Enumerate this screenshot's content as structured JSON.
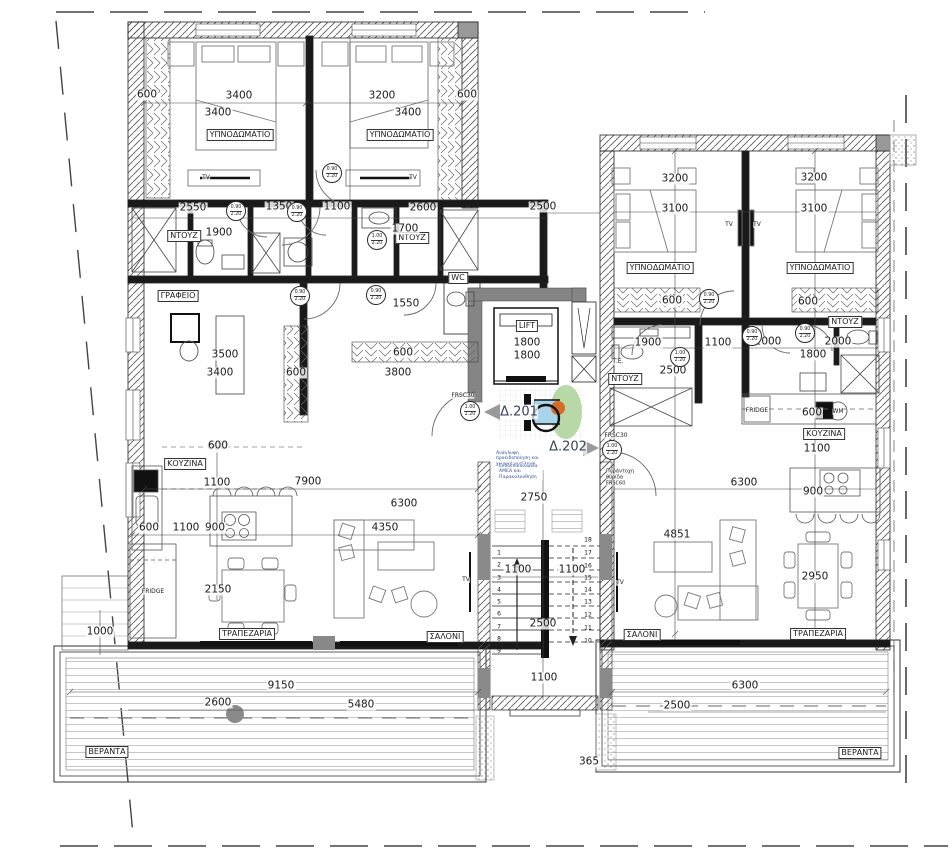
{
  "palette": {
    "wall_hatch": "#555",
    "wall_dark": "#1a1a1a",
    "wall_gray": "#858585",
    "boundary": "#444",
    "deck_line": "#b9b9b9",
    "accent_green": "#b8d8a8",
    "accent_blue": "#a7d4e8",
    "accent_orange": "#d96b28"
  },
  "labels": {
    "room": [
      {
        "t": "ΥΠΝΟΔΩΜΑΤΙΟ",
        "x": 240,
        "y": 135
      },
      {
        "t": "ΥΠΝΟΔΩΜΑΤΙΟ",
        "x": 400,
        "y": 135
      },
      {
        "t": "ΥΠΝΟΔΩΜΑΤΙΟ",
        "x": 660,
        "y": 268
      },
      {
        "t": "ΥΠΝΟΔΩΜΑΤΙΟ",
        "x": 820,
        "y": 268
      },
      {
        "t": "ΓΡΑΦΕΙΟ",
        "x": 178,
        "y": 296
      },
      {
        "t": "ΝΤΟΥΖ",
        "x": 184,
        "y": 236
      },
      {
        "t": "ΝΤΟΥΖ",
        "x": 412,
        "y": 238
      },
      {
        "t": "ΝΤΟΥΖ",
        "x": 845,
        "y": 322
      },
      {
        "t": "ΝΤΟΥΖ",
        "x": 625,
        "y": 379
      },
      {
        "t": "WC",
        "x": 458,
        "y": 278
      },
      {
        "t": "ΚΟΥΖΙΝΑ",
        "x": 185,
        "y": 464
      },
      {
        "t": "ΚΟΥΖΙΝΑ",
        "x": 824,
        "y": 434
      },
      {
        "t": "ΤΡΑΠΕΖΑΡΙΑ",
        "x": 247,
        "y": 634
      },
      {
        "t": "ΤΡΑΠΕΖΑΡΙΑ",
        "x": 818,
        "y": 634
      },
      {
        "t": "ΣΑΛΟΝΙ",
        "x": 445,
        "y": 637
      },
      {
        "t": "ΣΑΛΟΝΙ",
        "x": 642,
        "y": 635
      },
      {
        "t": "ΒΕΡΑΝΤΑ",
        "x": 107,
        "y": 752
      },
      {
        "t": "ΒΕΡΑΝΤΑ",
        "x": 860,
        "y": 753
      },
      {
        "t": "LIFT",
        "x": 527,
        "y": 326
      }
    ],
    "dim": [
      {
        "t": "600",
        "x": 147,
        "y": 95
      },
      {
        "t": "3400",
        "x": 239,
        "y": 96
      },
      {
        "t": "3400",
        "x": 218,
        "y": 113
      },
      {
        "t": "3200",
        "x": 382,
        "y": 96
      },
      {
        "t": "3400",
        "x": 408,
        "y": 113
      },
      {
        "t": "600",
        "x": 467,
        "y": 95
      },
      {
        "t": "2550",
        "x": 193,
        "y": 208
      },
      {
        "t": "1350",
        "x": 279,
        "y": 207
      },
      {
        "t": "1100",
        "x": 337,
        "y": 207
      },
      {
        "t": "2600",
        "x": 423,
        "y": 208
      },
      {
        "t": "1900",
        "x": 219,
        "y": 233
      },
      {
        "t": "1700",
        "x": 405,
        "y": 229
      },
      {
        "t": "1550",
        "x": 406,
        "y": 304
      },
      {
        "t": "3500",
        "x": 225,
        "y": 355
      },
      {
        "t": "3400",
        "x": 220,
        "y": 373
      },
      {
        "t": "600",
        "x": 296,
        "y": 373
      },
      {
        "t": "3800",
        "x": 398,
        "y": 373
      },
      {
        "t": "600",
        "x": 403,
        "y": 353
      },
      {
        "t": "600",
        "x": 217,
        "y": 447
      },
      {
        "t": "2500",
        "x": 543,
        "y": 207
      },
      {
        "t": "1800",
        "x": 527,
        "y": 343
      },
      {
        "t": "1800",
        "x": 527,
        "y": 356
      },
      {
        "t": "3200",
        "x": 675,
        "y": 179
      },
      {
        "t": "3100",
        "x": 675,
        "y": 209
      },
      {
        "t": "3200",
        "x": 814,
        "y": 178
      },
      {
        "t": "3100",
        "x": 814,
        "y": 209
      },
      {
        "t": "600",
        "x": 672,
        "y": 301
      },
      {
        "t": "600",
        "x": 808,
        "y": 302
      },
      {
        "t": "1900",
        "x": 648,
        "y": 343
      },
      {
        "t": "1100",
        "x": 718,
        "y": 343
      },
      {
        "t": "2000",
        "x": 768,
        "y": 342
      },
      {
        "t": "2000",
        "x": 838,
        "y": 342
      },
      {
        "t": "1800",
        "x": 813,
        "y": 355
      },
      {
        "t": "2500",
        "x": 673,
        "y": 371
      },
      {
        "t": "600",
        "x": 812,
        "y": 413
      },
      {
        "t": "1100",
        "x": 817,
        "y": 449
      },
      {
        "t": "900",
        "x": 813,
        "y": 492
      },
      {
        "t": "6300",
        "x": 744,
        "y": 483
      },
      {
        "t": "4851",
        "x": 677,
        "y": 535
      },
      {
        "t": "2950",
        "x": 815,
        "y": 577
      },
      {
        "t": "6300",
        "x": 745,
        "y": 686
      },
      {
        "t": "2500",
        "x": 677,
        "y": 706
      },
      {
        "t": "2750",
        "x": 534,
        "y": 498
      },
      {
        "t": "1100",
        "x": 518,
        "y": 570
      },
      {
        "t": "1100",
        "x": 572,
        "y": 570
      },
      {
        "t": "2500",
        "x": 543,
        "y": 624
      },
      {
        "t": "1100",
        "x": 544,
        "y": 678
      },
      {
        "t": "365",
        "x": 589,
        "y": 762
      },
      {
        "t": "600",
        "x": 218,
        "y": 446
      },
      {
        "t": "1100",
        "x": 217,
        "y": 483
      },
      {
        "t": "7900",
        "x": 308,
        "y": 482
      },
      {
        "t": "6300",
        "x": 404,
        "y": 504
      },
      {
        "t": "600",
        "x": 149,
        "y": 528
      },
      {
        "t": "1100",
        "x": 186,
        "y": 528
      },
      {
        "t": "900",
        "x": 215,
        "y": 528
      },
      {
        "t": "4350",
        "x": 385,
        "y": 528
      },
      {
        "t": "2150",
        "x": 218,
        "y": 590
      },
      {
        "t": "1000",
        "x": 100,
        "y": 632
      },
      {
        "t": "9150",
        "x": 281,
        "y": 686
      },
      {
        "t": "2600",
        "x": 218,
        "y": 703
      },
      {
        "t": "5480",
        "x": 361,
        "y": 705
      }
    ],
    "tiny": [
      {
        "t": "FRIDGE",
        "x": 153,
        "y": 592
      },
      {
        "t": "FRIDGE",
        "x": 757,
        "y": 411
      },
      {
        "t": "Τ.Ε.",
        "x": 618,
        "y": 362
      },
      {
        "t": "TV",
        "x": 206,
        "y": 178
      },
      {
        "t": "TV",
        "x": 413,
        "y": 178
      },
      {
        "t": "TV",
        "x": 729,
        "y": 225
      },
      {
        "t": "TV",
        "x": 757,
        "y": 225
      },
      {
        "t": "TV",
        "x": 466,
        "y": 580
      },
      {
        "t": "TV",
        "x": 620,
        "y": 583
      },
      {
        "t": "FRSC30",
        "x": 463,
        "y": 396
      },
      {
        "t": "FRSC30",
        "x": 616,
        "y": 436
      },
      {
        "t": "WM",
        "x": 838,
        "y": 412
      }
    ],
    "big": [
      {
        "t": "Δ.201",
        "x": 519,
        "y": 412
      },
      {
        "t": "Δ.202",
        "x": 568,
        "y": 447
      }
    ],
    "note": [
      {
        "t": "Πυράντοχη θυρίδα FRSC60",
        "x": 625,
        "y": 478,
        "w": 38
      }
    ],
    "noteblue": [
      {
        "t": "Ανάγλυφη προειδοποίηση και χωρική αντίληψη",
        "x": 524,
        "y": 459,
        "w": 56
      },
      {
        "t": "Ενδοεπικοινωνία ΑΜΕΑ και Παρακολούθηση",
        "x": 521,
        "y": 472,
        "w": 44
      }
    ],
    "stair": [
      {
        "t": "1",
        "x": 499,
        "y": 553
      },
      {
        "t": "2",
        "x": 499,
        "y": 565
      },
      {
        "t": "3",
        "x": 499,
        "y": 578
      },
      {
        "t": "4",
        "x": 499,
        "y": 590
      },
      {
        "t": "5",
        "x": 499,
        "y": 602
      },
      {
        "t": "6",
        "x": 499,
        "y": 614
      },
      {
        "t": "7",
        "x": 499,
        "y": 627
      },
      {
        "t": "8",
        "x": 499,
        "y": 639
      },
      {
        "t": "9",
        "x": 499,
        "y": 651
      },
      {
        "t": "18",
        "x": 588,
        "y": 540
      },
      {
        "t": "17",
        "x": 588,
        "y": 553
      },
      {
        "t": "16",
        "x": 588,
        "y": 566
      },
      {
        "t": "15",
        "x": 588,
        "y": 578
      },
      {
        "t": "14",
        "x": 588,
        "y": 590
      },
      {
        "t": "13",
        "x": 588,
        "y": 602
      },
      {
        "t": "12",
        "x": 588,
        "y": 615
      },
      {
        "t": "11",
        "x": 588,
        "y": 628
      },
      {
        "t": "10",
        "x": 588,
        "y": 641
      }
    ]
  },
  "door_tags": [
    {
      "x": 236,
      "y": 211,
      "a": "0.90",
      "b": "2.20"
    },
    {
      "x": 297,
      "y": 212,
      "a": "0.90",
      "b": "2.20"
    },
    {
      "x": 332,
      "y": 173,
      "a": "0.90",
      "b": "2.20"
    },
    {
      "x": 377,
      "y": 240,
      "a": "1.00",
      "b": "2.20"
    },
    {
      "x": 376,
      "y": 295,
      "a": "0.90",
      "b": "2.20"
    },
    {
      "x": 300,
      "y": 296,
      "a": "0.90",
      "b": "2.20"
    },
    {
      "x": 709,
      "y": 299,
      "a": "0.90",
      "b": "2.20"
    },
    {
      "x": 752,
      "y": 336,
      "a": "0.90",
      "b": "2.20"
    },
    {
      "x": 805,
      "y": 333,
      "a": "0.90",
      "b": "2.20"
    },
    {
      "x": 680,
      "y": 357,
      "a": "1.00",
      "b": "2.20"
    },
    {
      "x": 470,
      "y": 411,
      "a": "1.00",
      "b": "2.20"
    },
    {
      "x": 612,
      "y": 450,
      "a": "1.00",
      "b": "2.20"
    }
  ]
}
